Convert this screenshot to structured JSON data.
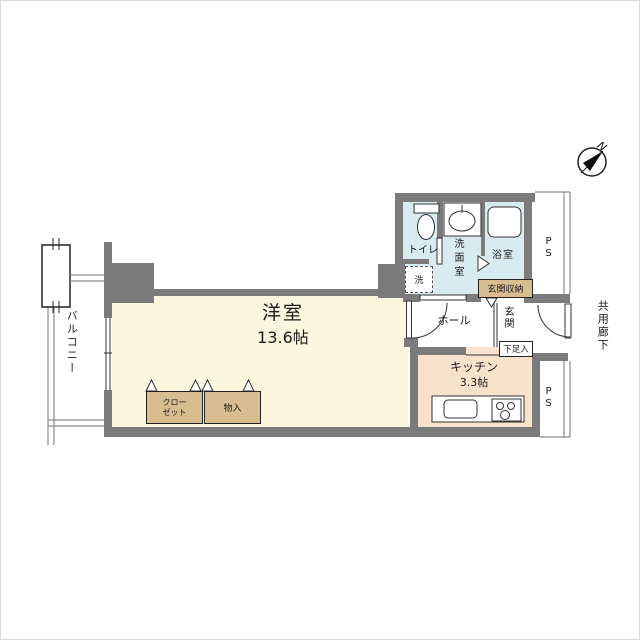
{
  "plan_title": "studio-apartment-floor-plan",
  "rooms": {
    "main_room": {
      "name": "洋室",
      "size": "13.6帖"
    },
    "kitchen": {
      "name": "キッチン",
      "size": "3.3帖"
    },
    "toilet": {
      "label": "トイレ"
    },
    "washroom": {
      "label": "洗面室"
    },
    "bathroom": {
      "label": "浴室"
    },
    "hall": {
      "label": "ホール"
    },
    "entrance": {
      "label": "玄関"
    },
    "entrance_storage": {
      "label": "玄関収納"
    },
    "shoe_box": {
      "label": "下足入"
    },
    "washer_space": {
      "label": "洗"
    },
    "closet": {
      "label": "クローゼット"
    },
    "storage": {
      "label": "物入"
    },
    "balcony": {
      "label": "バルコニー"
    },
    "common_corridor": {
      "label": "共用廊下"
    },
    "pipe_space_top": {
      "label": "PS"
    },
    "pipe_space_bottom": {
      "label": "PS"
    }
  },
  "compass": {
    "north_label": "N",
    "direction": "northeast-up"
  },
  "colors": {
    "wall": "#7b7b7b",
    "main_room_floor": "#faf7de",
    "kitchen_floor": "#f8e2cc",
    "wet_area_floor": "#d9eaf0",
    "storage_fill": "#d8bd90",
    "line": "#333333"
  }
}
